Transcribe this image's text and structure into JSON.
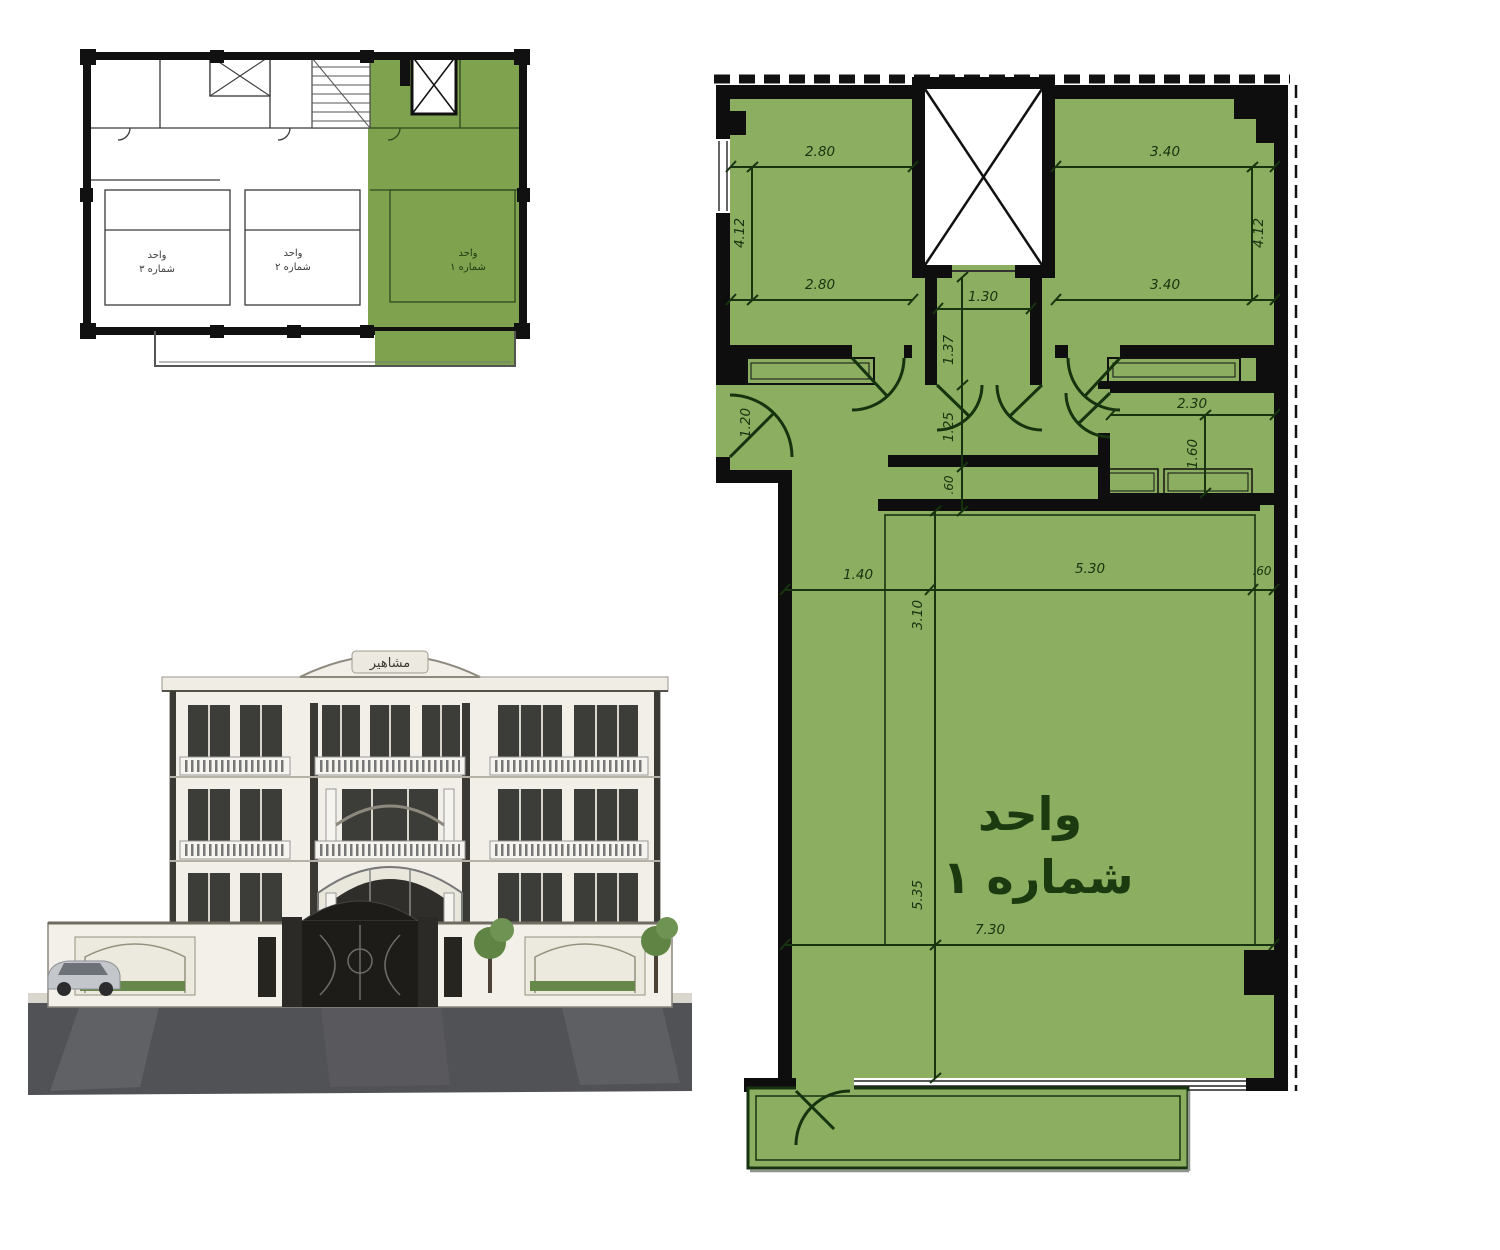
{
  "overview": {
    "unit1": {
      "line1": "واحد",
      "line2": "شماره ١"
    },
    "unit2": {
      "line1": "واحد",
      "line2": "شماره ٢"
    },
    "unit3": {
      "line1": "واحد",
      "line2": "شماره ٣"
    }
  },
  "render": {
    "sign": "مشاهیر"
  },
  "plan": {
    "unit_label": {
      "line1": "واحد",
      "line2": "شماره ١"
    },
    "dims": {
      "bed1_top": "2.80",
      "bed1_bot": "2.80",
      "bed1_h": "4.12",
      "bed2_top": "3.40",
      "bed2_bot": "3.40",
      "bed2_h": "4.12",
      "lobby_w": "1.30",
      "lobby_h": "1.37",
      "hall_h": "1.25",
      "entry_w": "1.20",
      "wc_w": "2.30",
      "wc_h": "1.60",
      "counter_d": ".60",
      "liv_a": "1.40",
      "liv_b": "5.30",
      "liv_c": ".60",
      "liv_v": "3.10",
      "liv_h": "5.35",
      "liv_w": "7.30"
    }
  },
  "colors": {
    "unit_fill": "#8cae61",
    "overview_unit_fill": "#7ea24e",
    "wall": "#0e0e0e",
    "dimension_ink": "#17330f"
  }
}
